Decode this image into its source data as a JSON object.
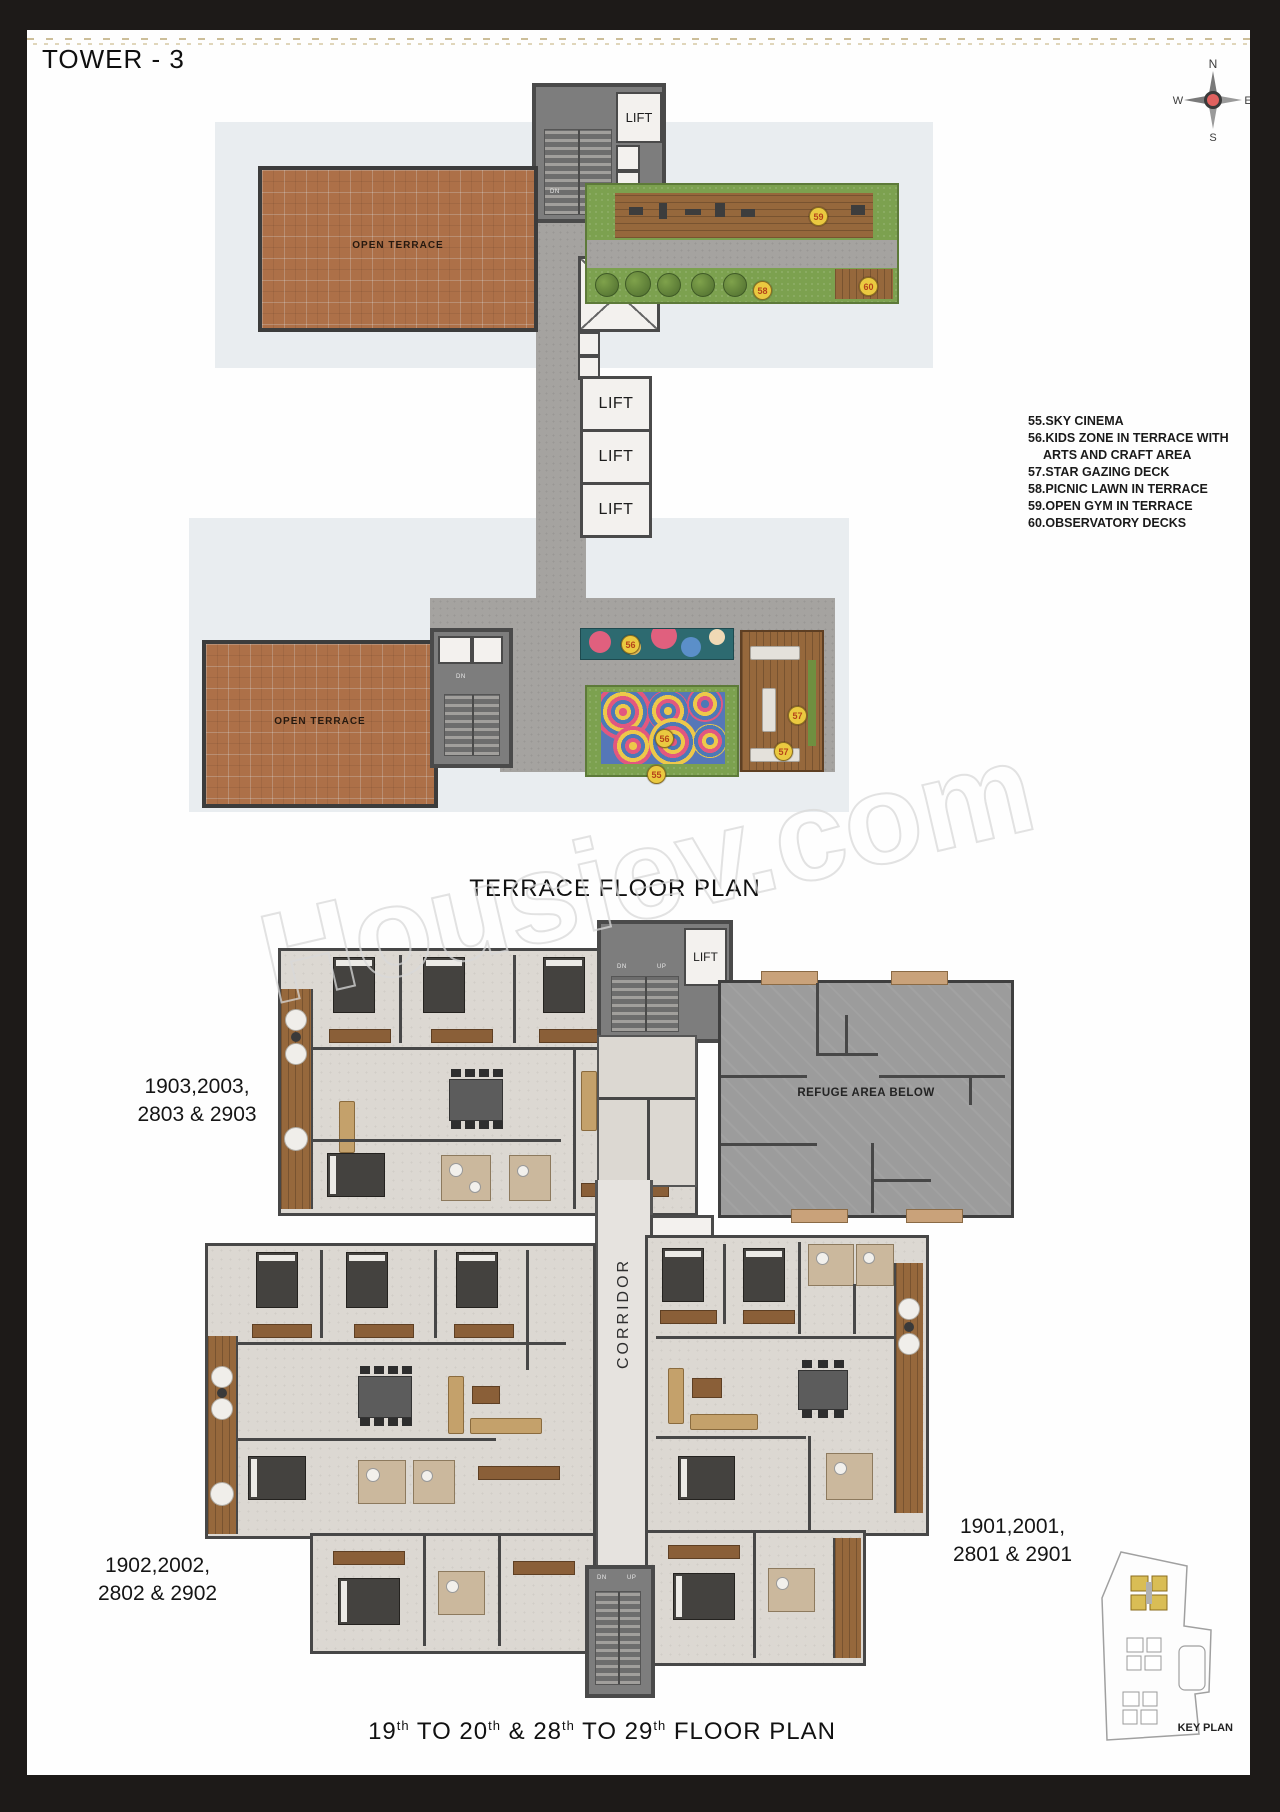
{
  "page": {
    "tower_title": "TOWER - 3",
    "terrace_plan_title": "TERRACE FLOOR PLAN",
    "floor_plan_title_parts": [
      "19",
      "th",
      " TO 20",
      "th",
      " & 28",
      "th",
      " TO 29",
      "th",
      " FLOOR PLAN"
    ],
    "watermark": "Housiev.com",
    "key_plan_label": "KEY PLAN"
  },
  "compass": {
    "north": "N",
    "east": "E",
    "south": "S",
    "west": "W"
  },
  "legend": {
    "items": [
      "55.SKY CINEMA",
      "56.KIDS ZONE IN TERRACE WITH",
      "ARTS AND CRAFT AREA",
      "57.STAR GAZING DECK",
      "58.PICNIC LAWN IN TERRACE",
      "59.OPEN GYM IN TERRACE",
      "60.OBSERVATORY DECKS"
    ]
  },
  "labels": {
    "lift": "LIFT",
    "corridor": "CORRIDOR",
    "open_terrace": "OPEN TERRACE",
    "refuge_area": "REFUGE AREA BELOW",
    "down": "DN",
    "up": "UP"
  },
  "badges": {
    "sky_cinema": "55",
    "kids_zone": "56",
    "star_gazing": "57",
    "picnic_lawn": "58",
    "open_gym": "59",
    "observatory_decks": "60"
  },
  "units": {
    "u1903": {
      "line1": "1903,2003,",
      "line2": "2803 & 2903"
    },
    "u1902": {
      "line1": "1902,2002,",
      "line2": "2802 & 2902"
    },
    "u1901": {
      "line1": "1901,2001,",
      "line2": "2801 & 2901"
    }
  },
  "colors": {
    "brick": "#ad7048",
    "grass": "#7ca14f",
    "wood": "#96683c",
    "plan_gray": "#a5a3a0",
    "wall": "#474747",
    "pale_shadow": "#e9edf0",
    "badge_bg": "#eac940",
    "badge_text": "#b5431a",
    "key_plan_highlight": "#d9bd55"
  }
}
